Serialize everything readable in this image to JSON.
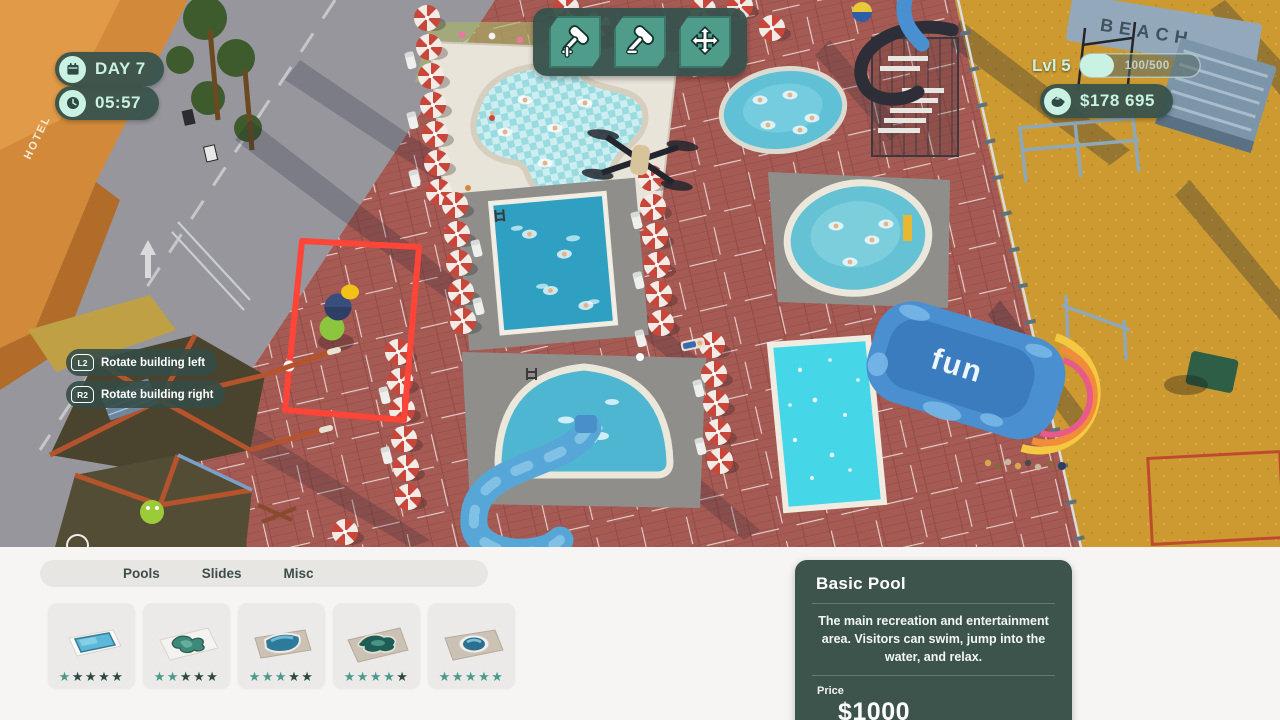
{
  "hud": {
    "day": "DAY 7",
    "time": "05:57",
    "level_label": "Lvl 5",
    "xp": "100/500",
    "money": "$178 695",
    "toolbar_icons": [
      "hammer-plus-build",
      "hammer-minus-demolish",
      "move-arrows"
    ],
    "hints": [
      {
        "button": "L2",
        "label": "Rotate building left"
      },
      {
        "button": "R2",
        "label": "Rotate building right"
      }
    ]
  },
  "scene": {
    "hotel_sign": "HOTEL",
    "beach_sign": "BEACH",
    "fun_slide_label": "fun"
  },
  "build_panel": {
    "tabs": [
      {
        "label": "Pools"
      },
      {
        "label": "Slides"
      },
      {
        "label": "Misc"
      }
    ],
    "items": [
      {
        "name": "basic-rectangular-pool",
        "rating": 1,
        "stars_filled": "★",
        "stars_empty": "★★★★"
      },
      {
        "name": "wave-shape-pool",
        "rating": 2,
        "stars_filled": "★★",
        "stars_empty": "★★★"
      },
      {
        "name": "rounded-corner-pool",
        "rating": 3,
        "stars_filled": "★★★",
        "stars_empty": "★★"
      },
      {
        "name": "lagoon-pool",
        "rating": 4,
        "stars_filled": "★★★★",
        "stars_empty": "★"
      },
      {
        "name": "round-island-pool",
        "rating": 5,
        "stars_filled": "★★★★★",
        "stars_empty": ""
      }
    ]
  },
  "detail_card": {
    "title": "Basic Pool",
    "description": "The main recreation and entertainment area. Visitors can swim, jump into the water, and relax.",
    "price_label": "Price",
    "price": "$1000"
  },
  "colors": {
    "hud_pill": "#38524c",
    "mint": "#c9f2e3",
    "tool_teal": "#4f9c8b",
    "star_filled": "#4a9a8c",
    "star_empty": "#2c4843",
    "selection_red": "#ff4438",
    "plaza_brick": "#a65a54",
    "sand": "#cc9a31"
  }
}
